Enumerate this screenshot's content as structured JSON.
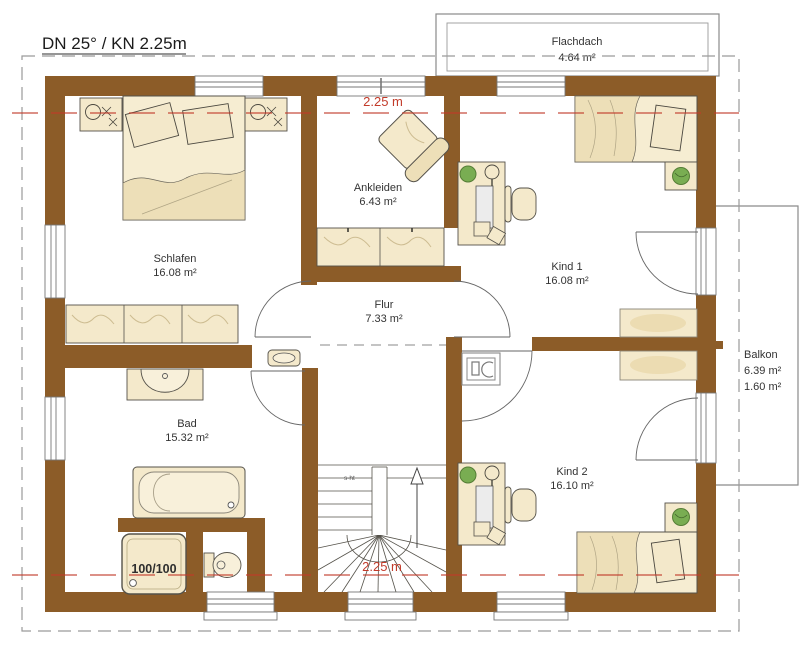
{
  "title": "DN 25° / KN 2.25m",
  "flachdach": {
    "name": "Flachdach",
    "area": "4.64 m²"
  },
  "rooms": {
    "schlafen": {
      "name": "Schlafen",
      "area": "16.08 m²"
    },
    "ankleiden": {
      "name": "Ankleiden",
      "area": "6.43 m²"
    },
    "kind1": {
      "name": "Kind 1",
      "area": "16.08 m²"
    },
    "flur": {
      "name": "Flur",
      "area": "7.33 m²"
    },
    "bad": {
      "name": "Bad",
      "area": "15.32 m²"
    },
    "kind2": {
      "name": "Kind 2",
      "area": "16.10 m²"
    }
  },
  "balkon": {
    "name": "Balkon",
    "area": "6.39 m²",
    "depth": "1.60 m²"
  },
  "annotations": {
    "knee_wall_top": "2.25 m",
    "knee_wall_bottom": "2.25 m",
    "shower_size": "100/100",
    "stair_note": "s-ht"
  },
  "colors": {
    "wall": "#8c5c28",
    "furniture": "#f4e9cb",
    "furniture_shade": "#ead8ab",
    "red_line": "#c23b2a",
    "plant": "#79ad52",
    "outline": "#55524a",
    "border_gray": "#9a9a9a"
  }
}
